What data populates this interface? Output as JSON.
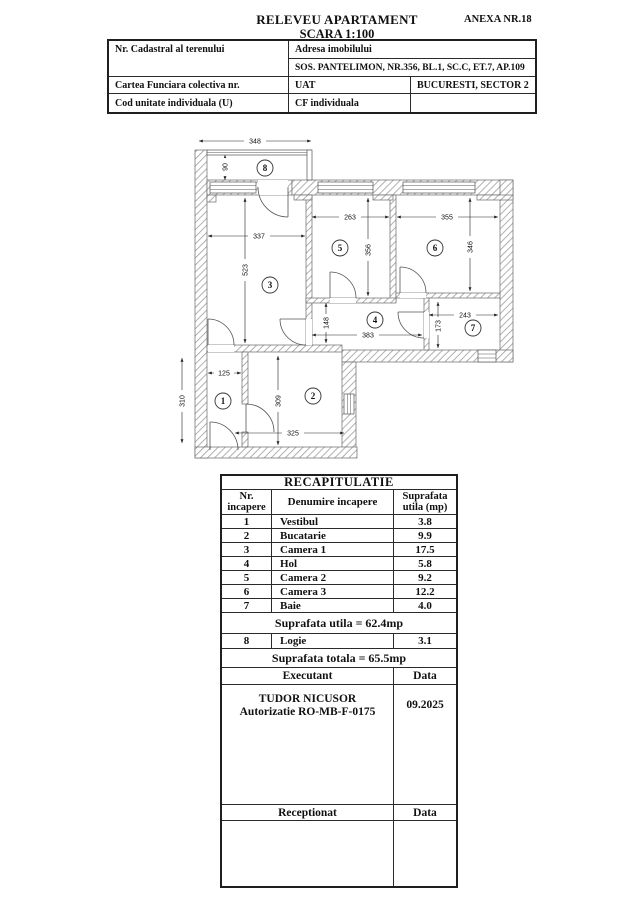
{
  "page": {
    "title": "RELEVEU APARTAMENT",
    "subtitle": "SCARA 1:100",
    "annex": "ANEXA NR.18"
  },
  "info_table": {
    "cadastral_label": "Nr. Cadastral al terenului",
    "address_label": "Adresa imobilului",
    "address_value": "SOS. PANTELIMON, NR.356, BL.1, SC.C, ET.7, AP.109",
    "cf_label": "Cartea Funciara colectiva nr.",
    "uat_label": "UAT",
    "uat_value": "BUCURESTI, SECTOR 2",
    "unit_code_label": "Cod unitate individuala (U)",
    "cf_individual_label": "CF individuala"
  },
  "floor_plan": {
    "room_numbers": {
      "r1": "1",
      "r2": "2",
      "r3": "3",
      "r4": "4",
      "r5": "5",
      "r6": "6",
      "r7": "7",
      "r8": "8"
    },
    "dims": {
      "d348": "348",
      "d90": "90",
      "d337": "337",
      "d523": "523",
      "d263": "263",
      "d356": "356",
      "d355": "355",
      "d346": "346",
      "d243": "243",
      "d173": "173",
      "d148": "148",
      "d383": "383",
      "d310": "310",
      "d125": "125",
      "d309": "309",
      "d325": "325"
    }
  },
  "recap_table": {
    "title": "RECAPITULATIE",
    "col_nr": "Nr. incapere",
    "col_name": "Denumire incapere",
    "col_area": "Suprafata utila (mp)",
    "rows": [
      {
        "nr": "1",
        "name": "Vestibul",
        "area": "3.8"
      },
      {
        "nr": "2",
        "name": "Bucatarie",
        "area": "9.9"
      },
      {
        "nr": "3",
        "name": "Camera 1",
        "area": "17.5"
      },
      {
        "nr": "4",
        "name": "Hol",
        "area": "5.8"
      },
      {
        "nr": "5",
        "name": "Camera 2",
        "area": "9.2"
      },
      {
        "nr": "6",
        "name": "Camera 3",
        "area": "12.2"
      },
      {
        "nr": "7",
        "name": "Baie",
        "area": "4.0"
      }
    ],
    "subtotal": "Suprafata utila = 62.4mp",
    "logie_row": {
      "nr": "8",
      "name": "Logie",
      "area": "3.1"
    },
    "total": "Suprafata totala = 65.5mp",
    "executant_label": "Executant",
    "data_label": "Data",
    "executant_name": "TUDOR NICUSOR",
    "executant_auth": "Autorizatie RO-MB-F-0175",
    "executant_date": "09.2025",
    "receptionat_label": "Receptionat",
    "receptionat_data_label": "Data"
  }
}
